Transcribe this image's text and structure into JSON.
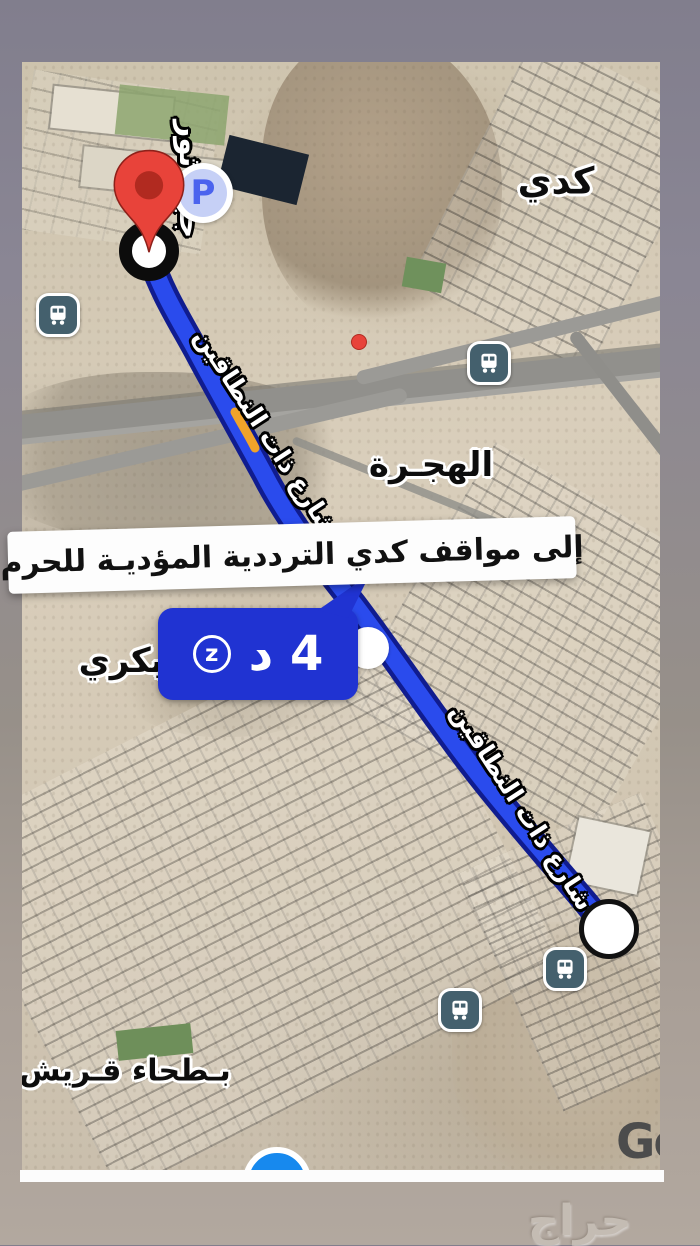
{
  "colors": {
    "route_blue": "#2a4bed",
    "route_outline": "#101c8f",
    "badge_blue": "#2033d2",
    "pin_red": "#e8433a",
    "traffic_orange": "#f0a32a",
    "location_blue": "#1789ee",
    "bus_icon_teal": "#44606d",
    "letterbox_top": "#817e8d",
    "letterbox_bottom": "#b2a89f"
  },
  "annotations": {
    "banner_text": "إلى مواقف كدي الترددية المؤديـة للحرم",
    "watermark": "حراج"
  },
  "route": {
    "duration_badge": "4 د",
    "badge_icon": "z"
  },
  "map_labels": {
    "district_kudai": "كدي",
    "district_hijrah": "الهجـرة",
    "district_bakri": "بكري",
    "district_batha_quraysh": "بـطحاء قـريش",
    "road_vertical": "جبل ثور",
    "route_road_upper": "شارع ذات النطاقين",
    "route_road_lower": "شارع ذات النطاقين",
    "parking": "P",
    "google_logo": "Go"
  }
}
